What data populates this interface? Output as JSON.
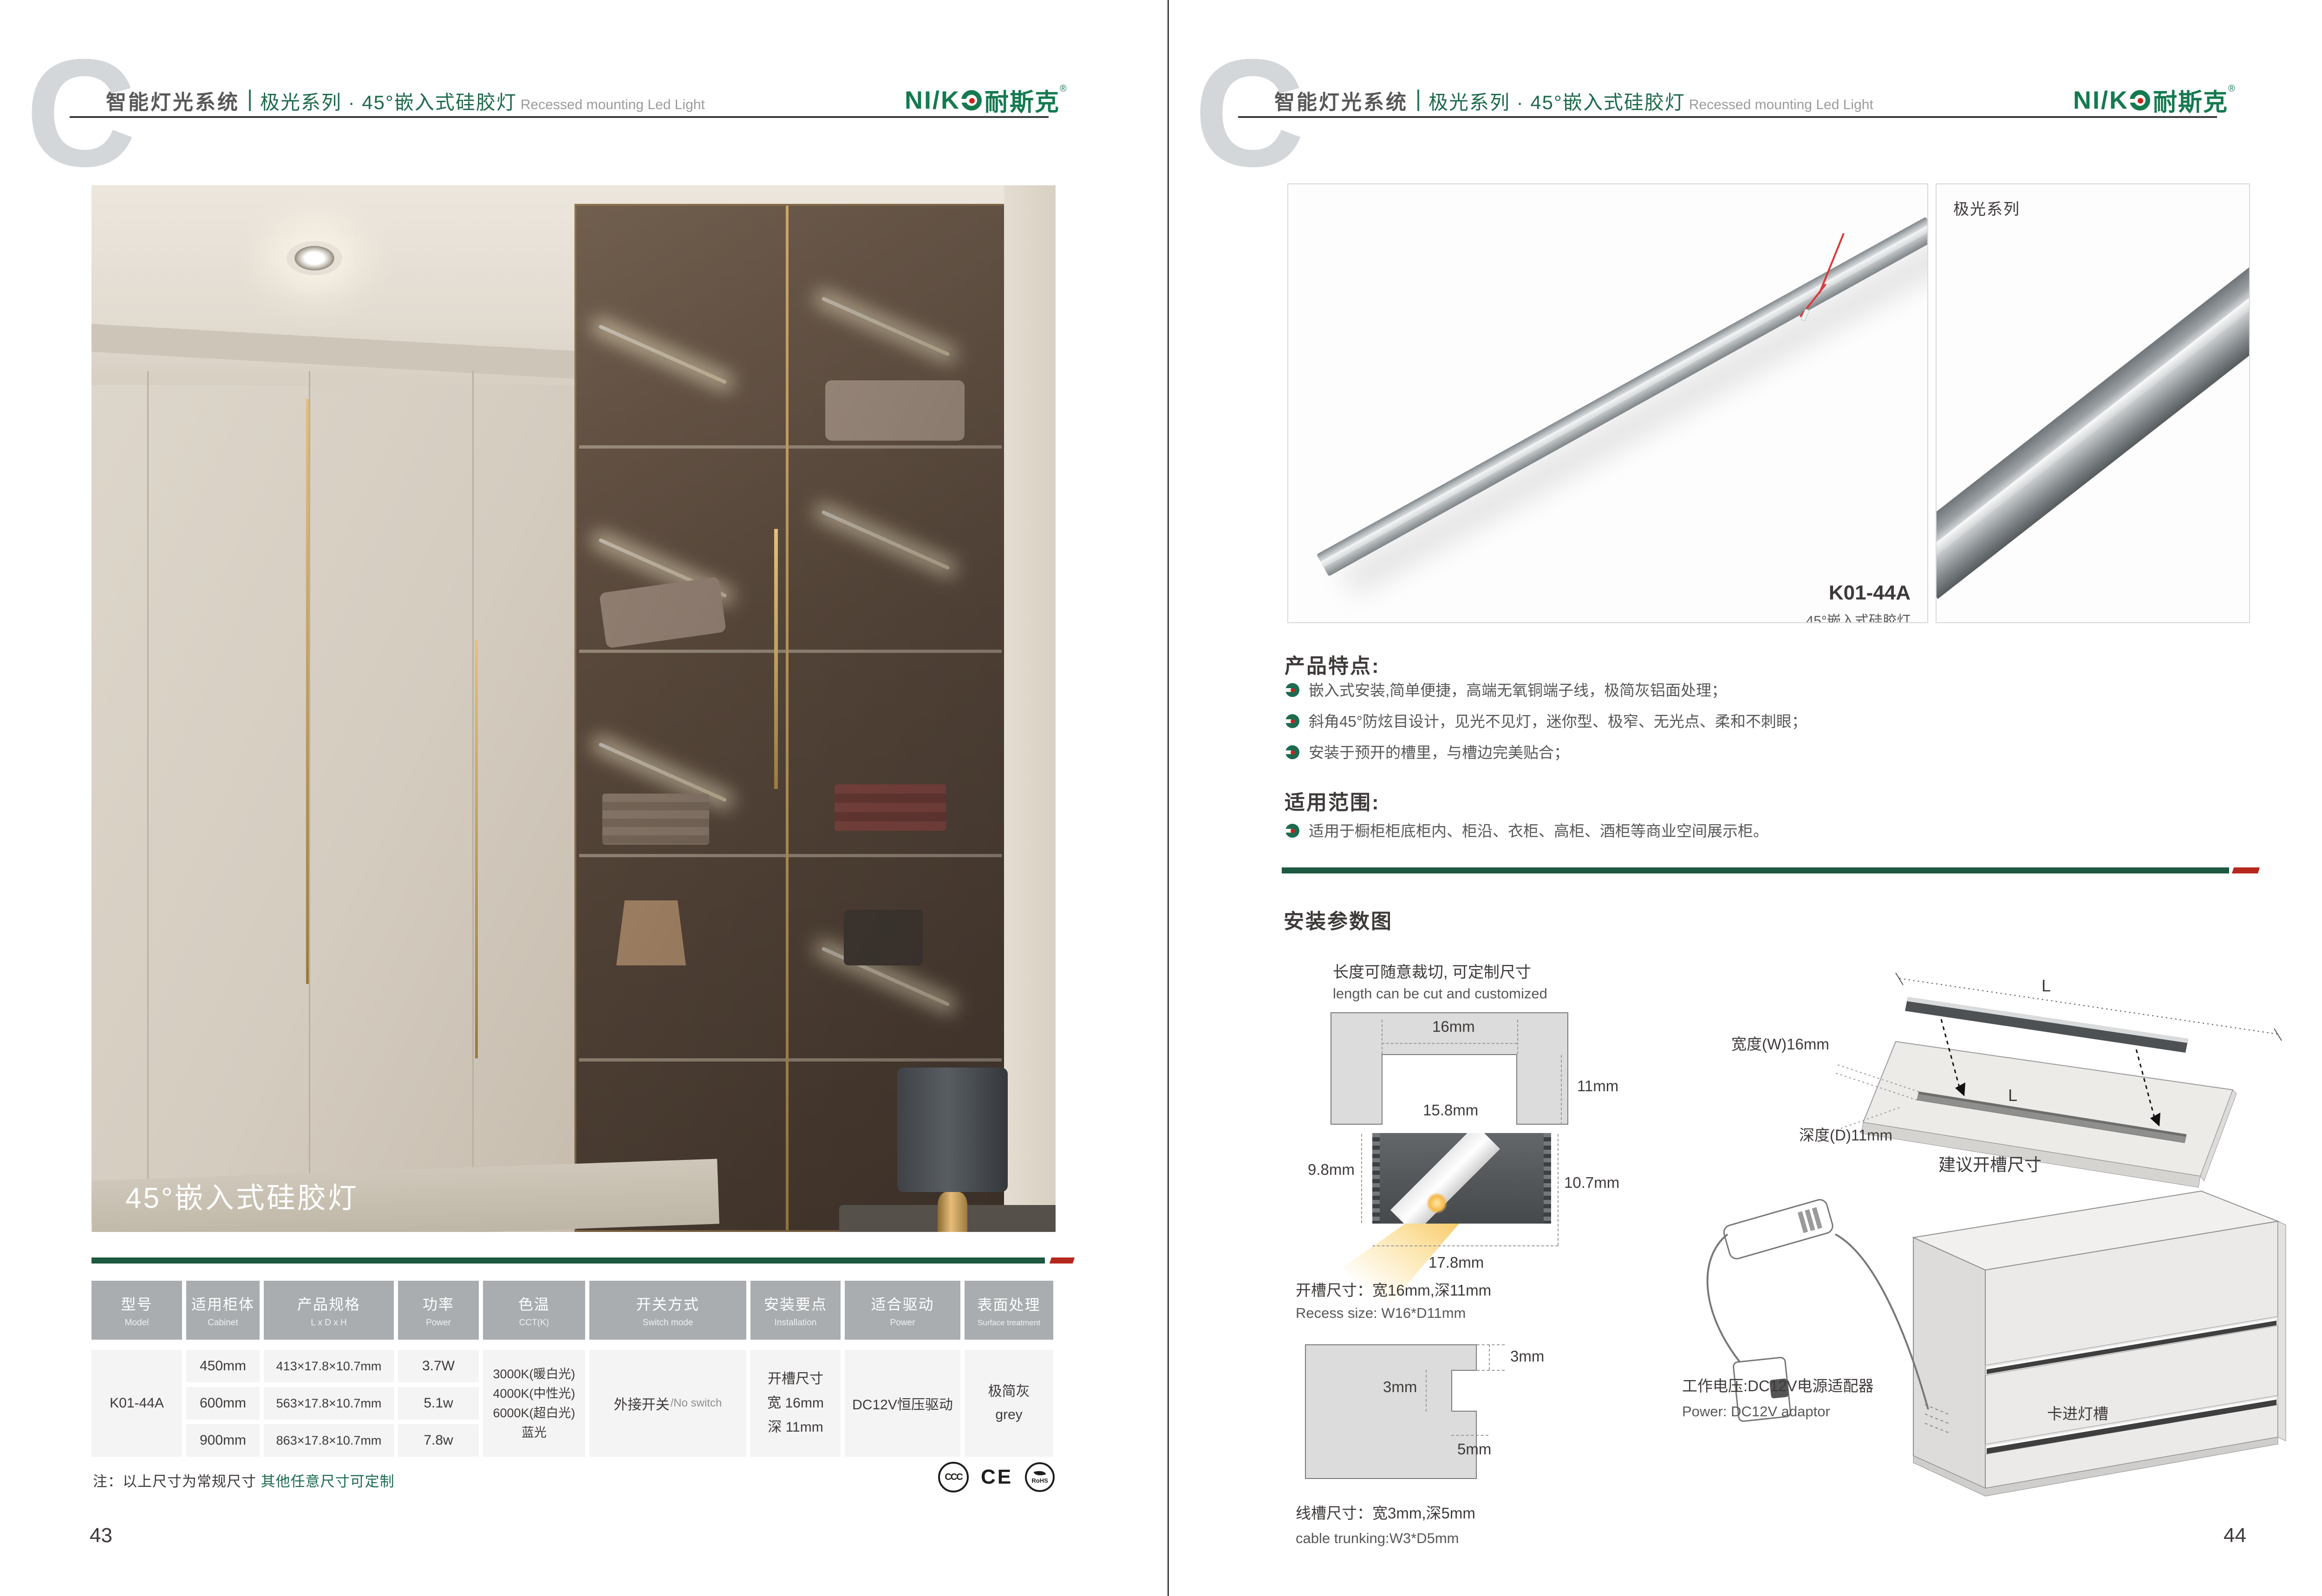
{
  "colors": {
    "brand_green": "#1e6a4d",
    "divider_green": "#1d5940",
    "accent_red": "#b6281e",
    "header_gray": "#a9adb0",
    "cell_bg": "#f4f4f4",
    "text_dark": "#3e3a39",
    "text_gray": "#595757",
    "cct_swatches": [
      "#a9dcf5",
      "#ffffff",
      "#f6ecd0",
      "#f3c96f"
    ]
  },
  "header": {
    "watermark": "C",
    "title_zh": "智能灯光系统",
    "series_title": "极光系列 · 45°嵌入式硅胶灯",
    "subtitle_en": "Recessed mounting Led Light"
  },
  "logo": {
    "latin": "NI/K",
    "cn": "耐斯克",
    "reg": "®"
  },
  "left": {
    "photo_caption": "45°嵌入式硅胶灯",
    "table": {
      "headers": [
        {
          "zh": "型号",
          "en": "Model"
        },
        {
          "zh": "适用柜体",
          "en": "Cabinet"
        },
        {
          "zh": "产品规格",
          "en": "L x D x H"
        },
        {
          "zh": "功率",
          "en": "Power"
        },
        {
          "zh": "色温",
          "en": "CCT(K)"
        },
        {
          "zh": "开关方式",
          "en": "Switch mode"
        },
        {
          "zh": "安装要点",
          "en": "Installation"
        },
        {
          "zh": "适合驱动",
          "en": "Power"
        },
        {
          "zh": "表面处理",
          "en": "Surface treatment"
        }
      ],
      "model": "K01-44A",
      "rows": [
        {
          "cabinet": "450mm",
          "size": "413×17.8×10.7mm",
          "power": "3.7W"
        },
        {
          "cabinet": "600mm",
          "size": "563×17.8×10.7mm",
          "power": "5.1w"
        },
        {
          "cabinet": "900mm",
          "size": "863×17.8×10.7mm",
          "power": "7.8w"
        }
      ],
      "cct": [
        "3000K(暖白光)",
        "4000K(中性光)",
        "6000K(超白光)",
        "蓝光"
      ],
      "switch_zh": "外接开关",
      "switch_en": "/No switch",
      "install_lines": [
        "开槽尺寸",
        "宽 16mm",
        "深 11mm"
      ],
      "driver": "DC12V恒压驱动",
      "surface_zh": "极简灰",
      "surface_en": "grey"
    },
    "note_prefix": "注：以上尺寸为常规尺寸 ",
    "note_highlight": "其他任意尺寸可定制",
    "certs": [
      "CCC",
      "CE",
      "RoHS"
    ],
    "page_number": "43"
  },
  "right": {
    "series_tag": "极光系列",
    "product_code": "K01-44A",
    "product_name": "45°嵌入式硅胶灯",
    "features_title": "产品特点:",
    "features": [
      "嵌入式安装,简单便捷，高端无氧铜端子线，极简灰铝面处理；",
      "斜角45°防炫目设计，见光不见灯，迷你型、极窄、无光点、柔和不刺眼；",
      "安装于预开的槽里，与槽边完美贴合；"
    ],
    "scope_title": "适用范围:",
    "scope": "适用于橱柜柜底柜内、柜沿、衣柜、高柜、酒柜等商业空间展示柜。",
    "install_title": "安装参数图",
    "cut_zh": "长度可随意裁切, 可定制尺寸",
    "cut_en": "length can be cut and customized",
    "recess": {
      "w": "16mm",
      "d": "11mm",
      "inner": "15.8mm",
      "h_left": "9.8mm",
      "h_right": "10.7mm",
      "w_bottom": "17.8mm",
      "label_zh": "开槽尺寸：宽16mm,深11mm",
      "label_en": "Recess size: W16*D11mm"
    },
    "trunk": {
      "t1": "3mm",
      "t2": "3mm",
      "t3": "5mm",
      "label_zh": "线槽尺寸：宽3mm,深5mm",
      "label_en": "cable trunking:W3*D5mm"
    },
    "board": {
      "L_top": "L",
      "L_groove": "L",
      "width_label": "宽度(W)16mm",
      "depth_label": "深度(D)11mm",
      "caption": "建议开槽尺寸"
    },
    "cabinet": {
      "power_zh": "工作电压:DC12V电源适配器",
      "power_en": "Power: DC12V adaptor",
      "clip": "卡进灯槽"
    },
    "page_number": "44"
  },
  "chart_data": {
    "type": "table",
    "title": "6500K",
    "beam_angle": "90°",
    "distance_label": "distance",
    "rows": [
      {
        "lx": "200lx",
        "mm": "250mm"
      },
      {
        "lx": "88lx",
        "mm": "500mm"
      },
      {
        "lx": "45lx",
        "mm": "750mm"
      },
      {
        "lx": "33lx",
        "mm": "1000mm"
      }
    ],
    "cct_options": [
      {
        "zh": "冰蓝光",
        "en": "Basket"
      },
      {
        "zh": "超白光",
        "en": "White"
      },
      {
        "zh": "中性光",
        "en": "Cool White"
      },
      {
        "zh": "暖白光",
        "en": "Warm White"
      }
    ]
  }
}
